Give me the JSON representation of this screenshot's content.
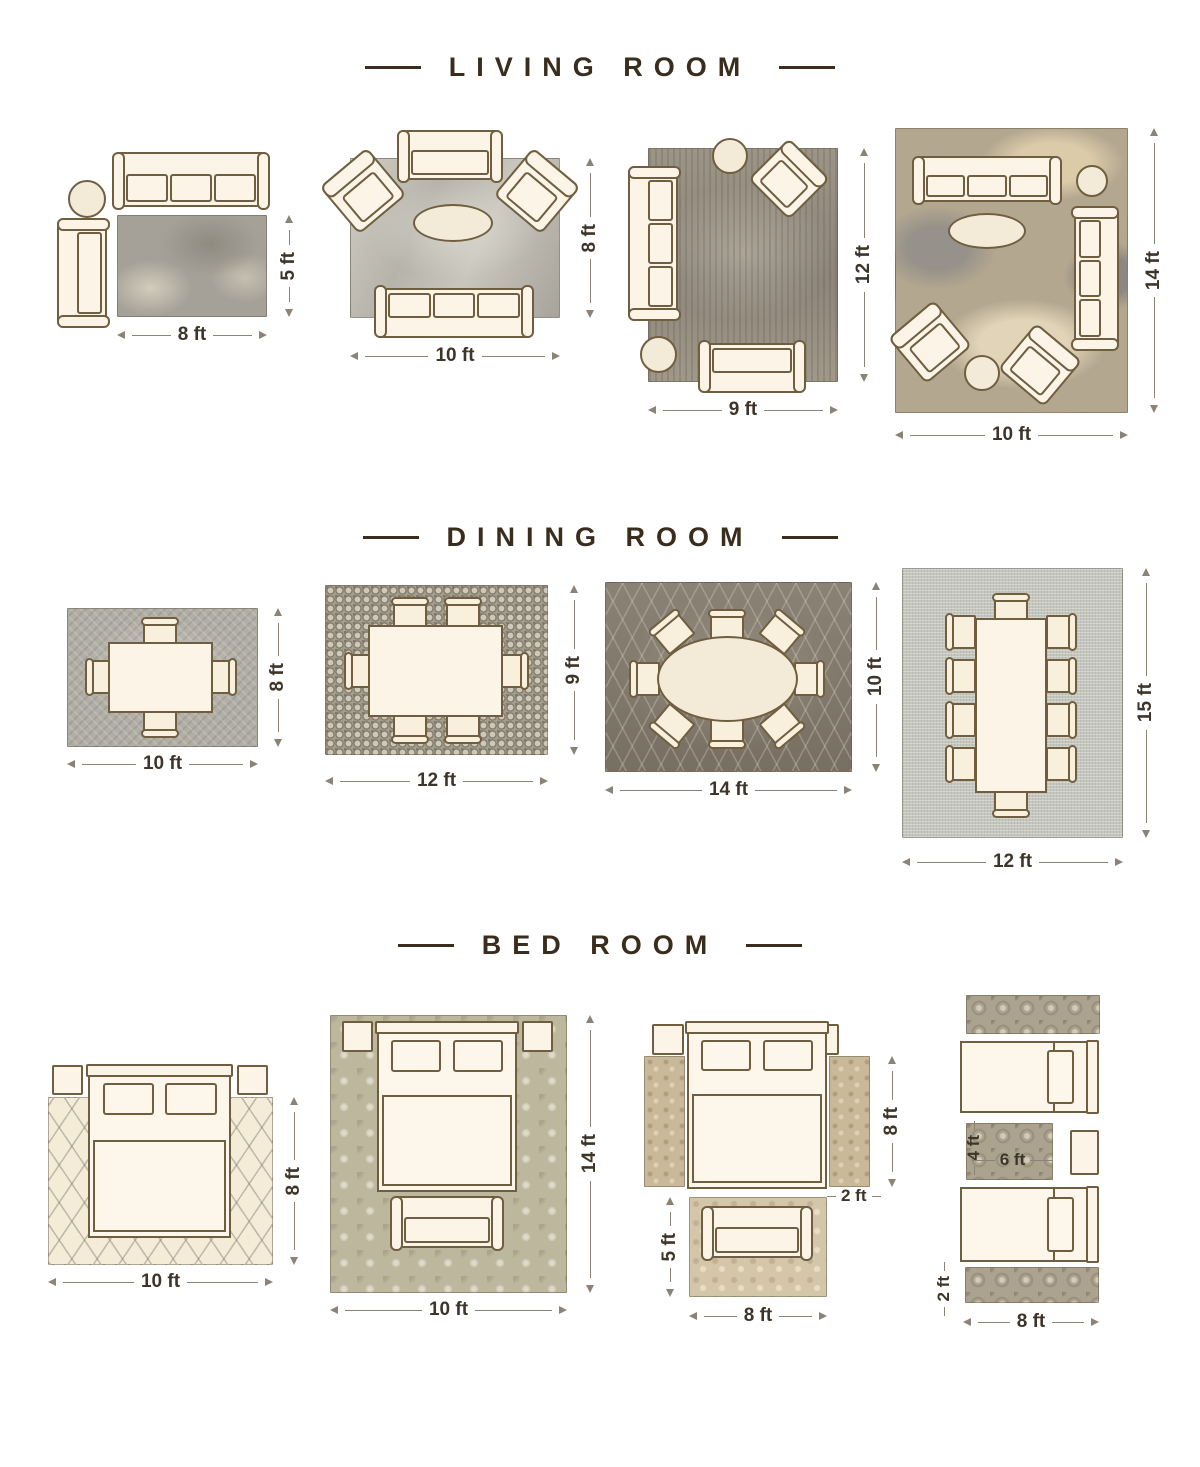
{
  "page": {
    "background": "#ffffff"
  },
  "colors": {
    "title_text": "#3b2d1d",
    "dimension_text": "#3e352a",
    "dimension_line": "#8a8376",
    "furniture_outline": "#6f5f40",
    "furniture_fill": "#fcf5e7"
  },
  "sections": {
    "living": {
      "title": "LIVING ROOM",
      "layouts": [
        {
          "width": "8 ft",
          "height": "5 ft"
        },
        {
          "width": "10 ft",
          "height": "8 ft"
        },
        {
          "width": "9 ft",
          "height": "12 ft"
        },
        {
          "width": "10 ft",
          "height": "14 ft"
        }
      ]
    },
    "dining": {
      "title": "DINING ROOM",
      "layouts": [
        {
          "width": "10 ft",
          "height": "8 ft"
        },
        {
          "width": "12 ft",
          "height": "9 ft"
        },
        {
          "width": "14 ft",
          "height": "10 ft"
        },
        {
          "width": "12 ft",
          "height": "15 ft"
        }
      ]
    },
    "bedroom": {
      "title": "BED ROOM",
      "layouts": [
        {
          "width": "10 ft",
          "height": "8 ft"
        },
        {
          "width": "10 ft",
          "height": "14 ft"
        },
        {
          "runner_length": "8 ft",
          "runner_width": "2 ft",
          "rug_height": "5 ft",
          "rug_width": "8 ft"
        },
        {
          "mat_height": "4 ft",
          "mat_width": "6 ft",
          "runner_width": "2 ft",
          "runner_length": "8 ft"
        }
      ]
    }
  }
}
